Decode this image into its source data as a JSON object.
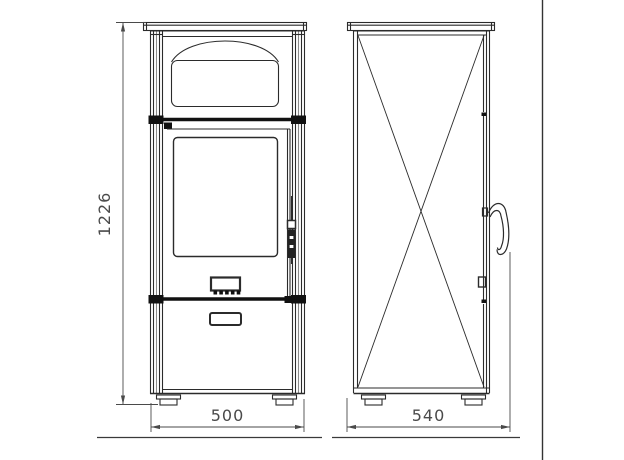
{
  "drawing": {
    "dimensions": {
      "height": "1226",
      "front_width": "500",
      "side_depth": "540"
    },
    "colors": {
      "background": "#ffffff",
      "line": "#2b2b2b",
      "bold_line": "#111111",
      "dimension": "#4a4a4a"
    }
  }
}
